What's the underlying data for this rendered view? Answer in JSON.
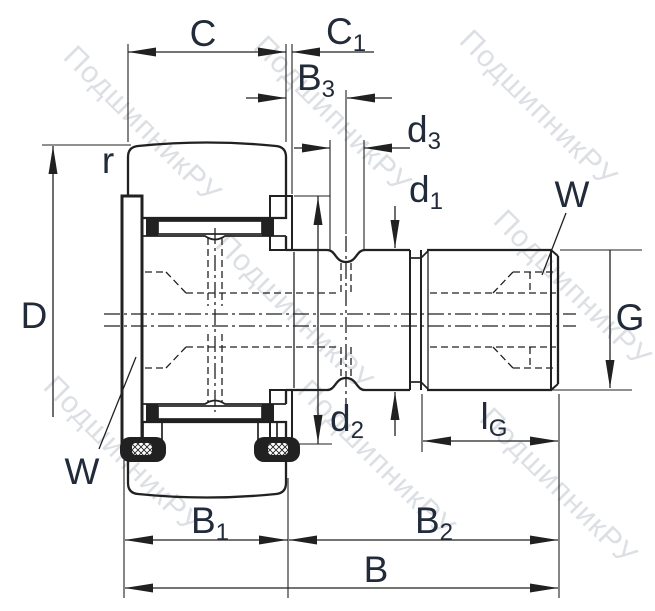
{
  "title": "Stud-type track roller cam follower bearing — dimensional cross-section drawing",
  "watermark": {
    "text": "ПодшипникРУ"
  },
  "colors": {
    "line": "#212121",
    "label": "#222b3a",
    "wm": "#c6cad1",
    "bg": "#ffffff"
  },
  "labels": {
    "C": {
      "base": "C",
      "sub": ""
    },
    "C1": {
      "base": "C",
      "sub": "1"
    },
    "B3": {
      "base": "B",
      "sub": "3"
    },
    "d3": {
      "base": "d",
      "sub": "3"
    },
    "d1": {
      "base": "d",
      "sub": "1"
    },
    "r": {
      "base": "r",
      "sub": ""
    },
    "D": {
      "base": "D",
      "sub": ""
    },
    "W_thread_end": {
      "base": "W",
      "sub": ""
    },
    "G": {
      "base": "G",
      "sub": ""
    },
    "W_flange_end": {
      "base": "W",
      "sub": ""
    },
    "d2": {
      "base": "d",
      "sub": "2"
    },
    "lG": {
      "base": "l",
      "sub": "G"
    },
    "B1": {
      "base": "B",
      "sub": "1"
    },
    "B2": {
      "base": "B",
      "sub": "2"
    },
    "B": {
      "base": "B",
      "sub": ""
    }
  }
}
